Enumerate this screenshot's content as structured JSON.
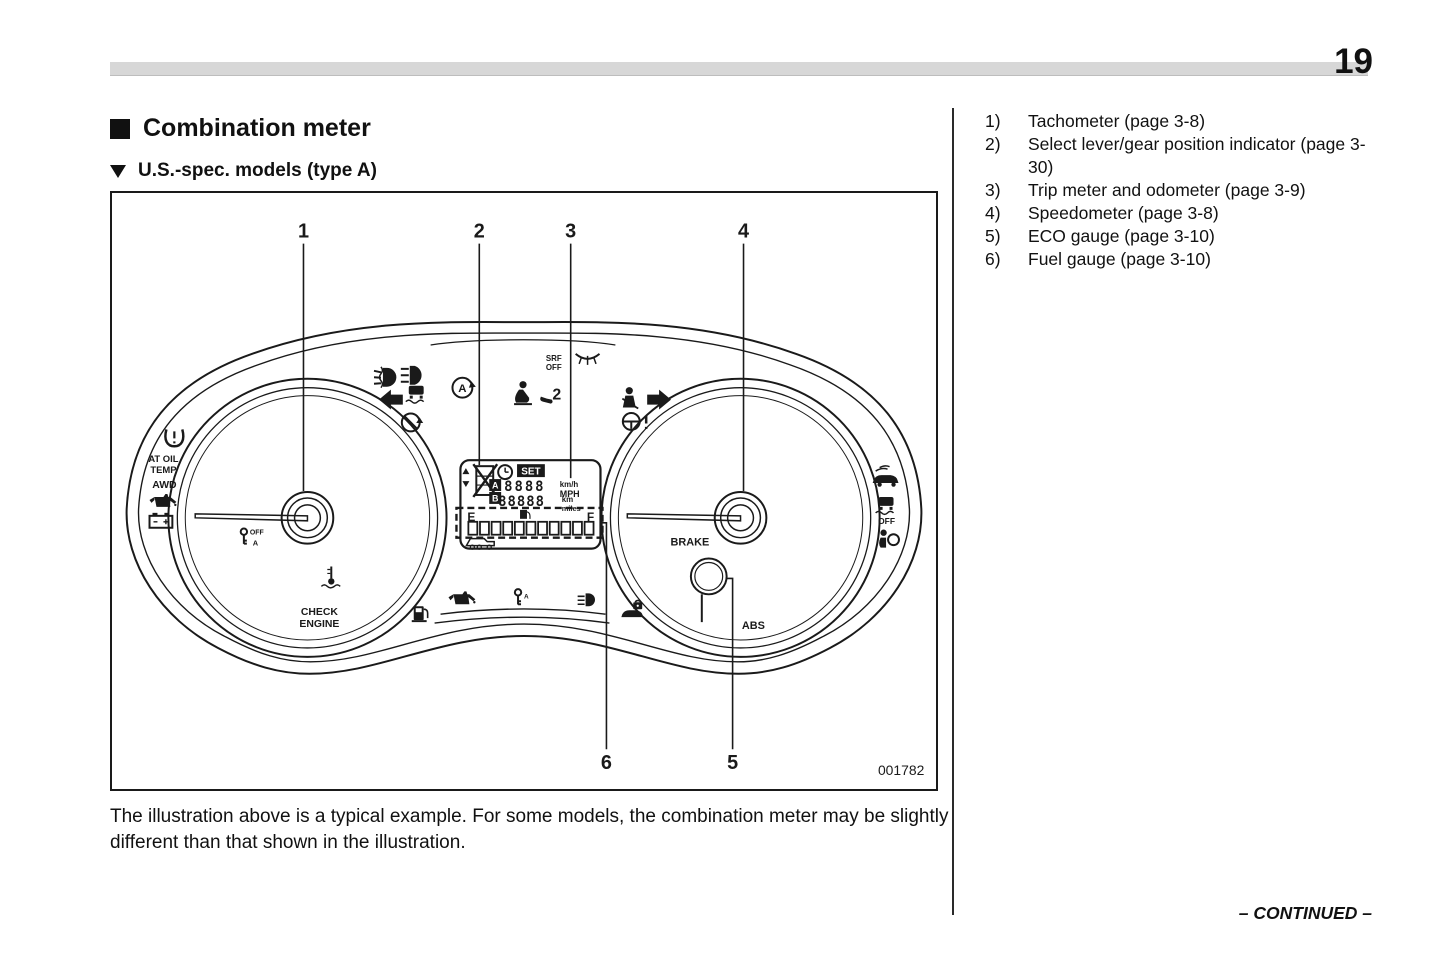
{
  "page": {
    "number": "19",
    "continued": "– CONTINUED –"
  },
  "header": {
    "title": "Combination meter",
    "subtitle": "U.S.-spec. models (type A)"
  },
  "figure": {
    "code": "001782",
    "callouts": {
      "c1": "1",
      "c2": "2",
      "c3": "3",
      "c4": "4",
      "c5": "5",
      "c6": "6"
    },
    "labels": {
      "at_oil_1": "AT OIL",
      "at_oil_2": "TEMP",
      "awd": "AWD",
      "check_1": "CHECK",
      "check_2": "ENGINE",
      "brake": "BRAKE",
      "abs": "ABS",
      "srf_1": "SRF",
      "srf_2": "OFF",
      "set": "SET",
      "trip_a": "A",
      "trip_b": "B",
      "digits_row1": "8888",
      "digits_row2": "88888",
      "unit_kmh": "km/h",
      "unit_mph": "MPH",
      "unit_km": "km",
      "unit_miles": "miles",
      "fuel_e": "E",
      "fuel_f": "F",
      "vdc_off": "OFF",
      "key_off": "OFF",
      "key_a": "A",
      "cruise_a": "A",
      "gear_2": "2"
    }
  },
  "caption": "The illustration above is a typical example. For some models, the combination meter may be slightly different than that shown in the illustration.",
  "legend": {
    "items": [
      {
        "num": "1)",
        "text": "Tachometer (page 3-8)"
      },
      {
        "num": "2)",
        "text": "Select lever/gear position indicator (page 3-30)"
      },
      {
        "num": "3)",
        "text": "Trip meter and odometer (page 3-9)"
      },
      {
        "num": "4)",
        "text": "Speedometer (page 3-8)"
      },
      {
        "num": "5)",
        "text": "ECO gauge (page 3-10)"
      },
      {
        "num": "6)",
        "text": "Fuel gauge (page 3-10)"
      }
    ]
  }
}
